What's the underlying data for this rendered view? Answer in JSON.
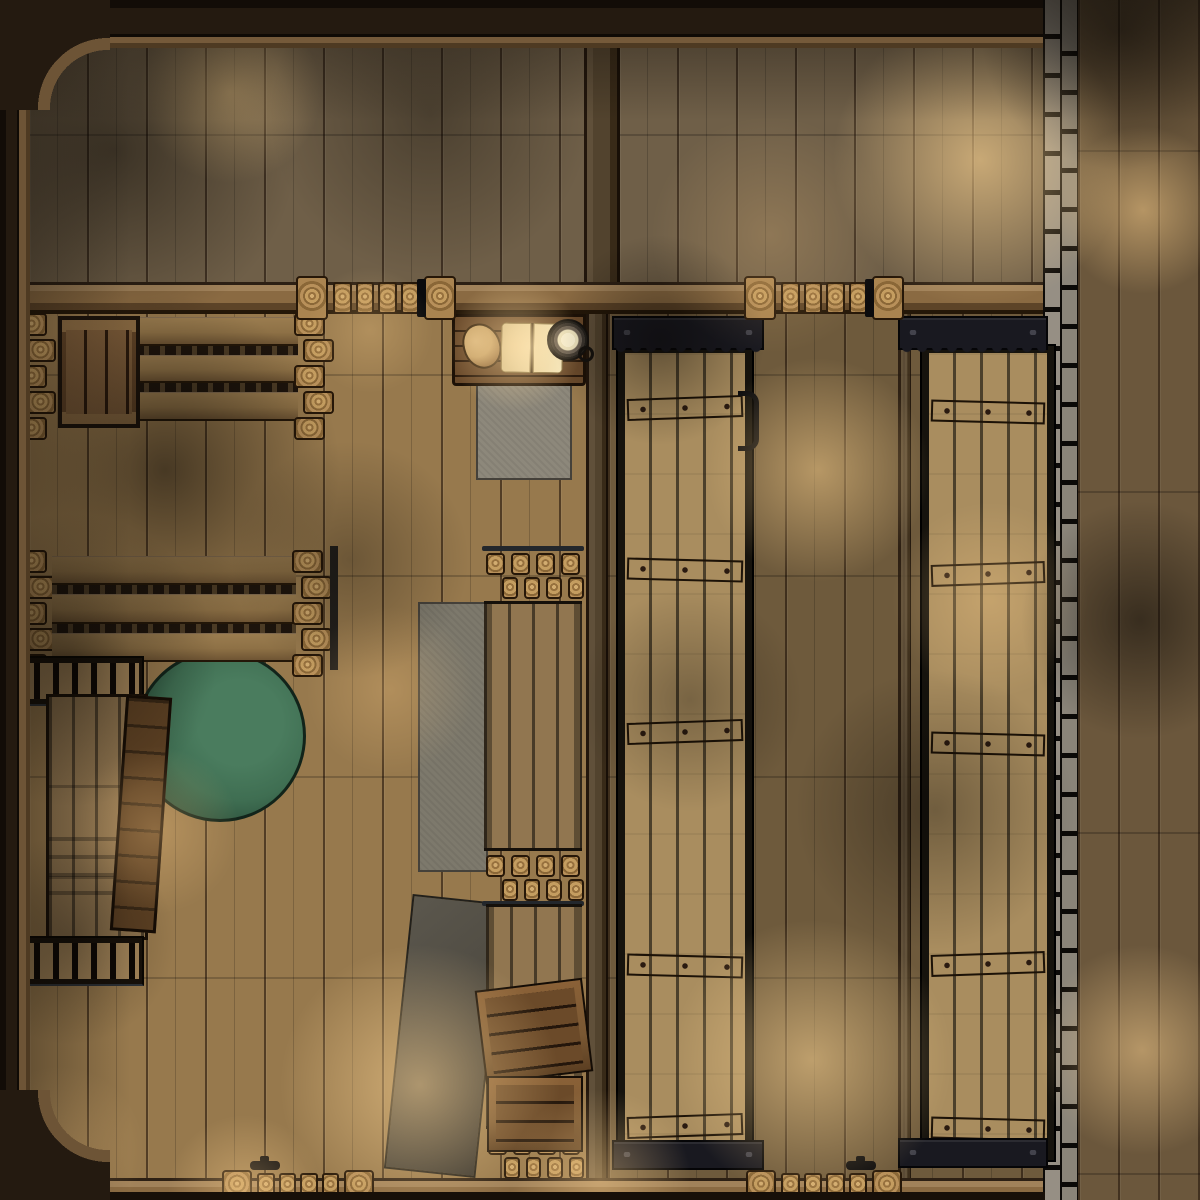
{
  "scene": {
    "type": "top-down-battlemap",
    "environment": "candle-lit wooden interior (ship lower deck / tavern) at night",
    "grid_overlay": false,
    "rooms": [
      "upper-cabin-left",
      "upper-cabin-right",
      "mess-hall-with-tables",
      "cargo-bay-with-two-long-hatches",
      "stone-walled-side-corridor"
    ],
    "objects": [
      {
        "name": "writing-desk",
        "contents": [
          "coin-pouch",
          "open-book",
          "candle-dish"
        ]
      },
      {
        "name": "gray-rug-under-desk"
      },
      {
        "name": "gray-runner-rug"
      },
      {
        "name": "round-green-rug"
      },
      {
        "name": "tilted-gray-tarp"
      },
      {
        "name": "long-plank-table",
        "count": 2
      },
      {
        "name": "log-seat-stack",
        "count": 4
      },
      {
        "name": "bench-row",
        "count": 2
      },
      {
        "name": "wooden-crate-on-table"
      },
      {
        "name": "tilted-plank-crate"
      },
      {
        "name": "stacked-gangplanks"
      },
      {
        "name": "gangplank-walkway",
        "count": 2
      },
      {
        "name": "tilted-crate-on-walkway"
      },
      {
        "name": "crate-on-walkway"
      },
      {
        "name": "cargo-hatch-door",
        "count": 2,
        "features": [
          "iron-frame",
          "scalloped-hinge-plates",
          "wood-cross-braces",
          "pull-handle"
        ]
      },
      {
        "name": "sliding-wall-door",
        "count": 4,
        "features": [
          "ring-grain-end-posts",
          "ring-grain-planks",
          "black-latch"
        ]
      },
      {
        "name": "stone-block-wall"
      },
      {
        "name": "hull-frame-with-rounded-corners"
      }
    ]
  },
  "colors": {
    "frame-dark": "#1f1711",
    "frame-trim": "#6d5436",
    "wall-beam": "#8a6a42",
    "beam-dark": "#241708",
    "floor-main": "#97794d",
    "floor-top": "#6f5f48",
    "floor-hold": "#6e5a3c",
    "corridor": "#6b573c",
    "stone": "#968f84",
    "grout": "#0c0a08",
    "hatch-plank": "#a98d5f",
    "hatch-iron": "#16130d",
    "brace-wood": "#c8a770",
    "iron-plate": "#191920",
    "walk-plank": "#917650",
    "table-wood": "#8e7146",
    "bench-wood": "#a8895c",
    "crate-frame": "#7a5833",
    "crate-dark": "#5c4023",
    "rug-green": "#3f6e52",
    "rug-green-dark": "#254634",
    "rug-gray": "#8d887b",
    "rug-gray-dark": "#45413a",
    "tarp-gray": "#4f4b42",
    "desk-wood": "#5e4126",
    "book-page": "#ecd9a8",
    "pouch-tan": "#c9a56c",
    "candle-wax": "#f2e9c4",
    "glow": "#ffd694",
    "shadow": "#0a0704"
  }
}
